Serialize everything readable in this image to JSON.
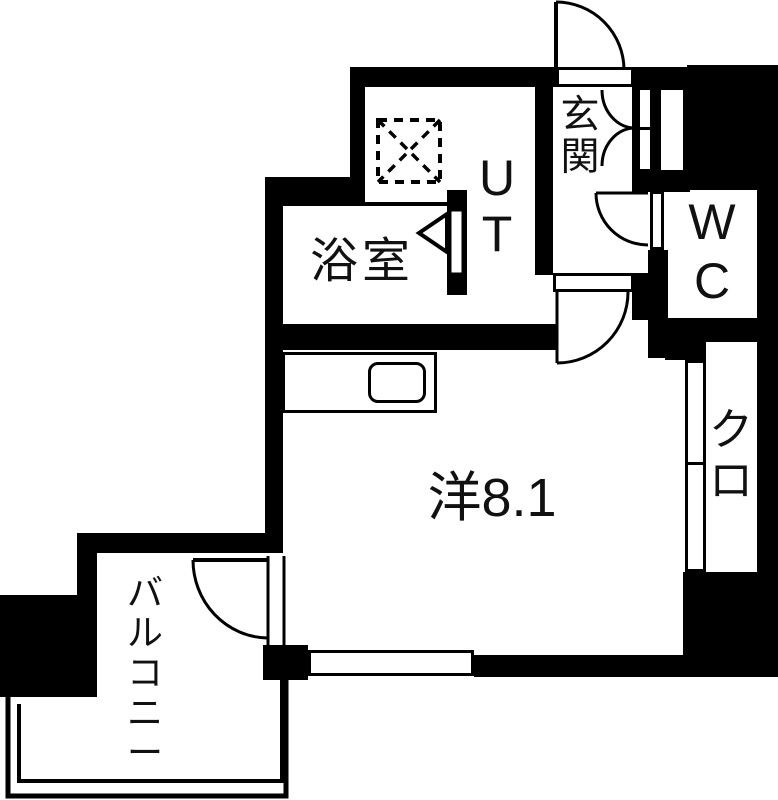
{
  "title": "apartment-floor-plan",
  "colors": {
    "wall": "#000000",
    "floor": "#ffffff",
    "line": "#000000",
    "text": "#111111"
  },
  "rooms": [
    {
      "name": "entrance",
      "label": "玄関",
      "orientation": "vertical"
    },
    {
      "name": "utility",
      "label": "UT",
      "orientation": "vertical"
    },
    {
      "name": "bathroom",
      "label": "浴室",
      "orientation": "horizontal"
    },
    {
      "name": "toilet",
      "label": "WC",
      "orientation": "vertical"
    },
    {
      "name": "western-room",
      "label": "洋8.1",
      "orientation": "horizontal",
      "size_tatami": "8.1"
    },
    {
      "name": "closet",
      "label": "クロ",
      "orientation": "vertical"
    },
    {
      "name": "balcony",
      "label": "バルコニー",
      "orientation": "vertical"
    }
  ],
  "fixtures": [
    {
      "name": "washing-machine-place",
      "symbol": "dashed-square-with-x"
    },
    {
      "name": "kitchen-counter-sink",
      "symbol": "rounded-rectangle"
    },
    {
      "name": "entrance-door",
      "symbol": "quarter-arc-swing-door"
    },
    {
      "name": "shoe-cabinet-doors",
      "symbol": "double-swing-arcs"
    },
    {
      "name": "wc-door",
      "symbol": "quarter-arc-swing-door"
    },
    {
      "name": "room-door",
      "symbol": "quarter-arc-swing-door"
    },
    {
      "name": "balcony-door",
      "symbol": "quarter-arc-swing-door"
    },
    {
      "name": "bathroom-folding-door",
      "symbol": "triangle-arrow"
    },
    {
      "name": "window",
      "symbol": "double-line"
    },
    {
      "name": "balcony-railing",
      "symbol": "double-line"
    }
  ]
}
